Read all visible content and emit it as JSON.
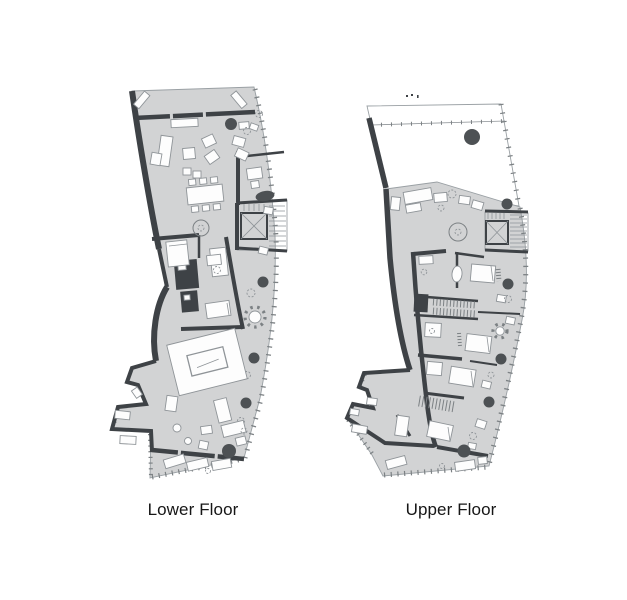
{
  "captions": {
    "note": "floor plan sheet with two stacked apartment levels",
    "lower": "Lower Floor",
    "upper": "Upper Floor"
  },
  "plans": [
    {
      "id": "lower-floor",
      "label": "Lower Floor"
    },
    {
      "id": "upper-floor",
      "label": "Upper Floor"
    }
  ],
  "colors": {
    "background": "#ffffff",
    "floor": "#d2d3d4",
    "wall": "#3e4246",
    "furniture-fill": "#fdfdfd",
    "furniture-outline": "#8f9498",
    "column": "#4d5154",
    "edge": "#9aa0a4",
    "hatch": "#7c8184",
    "text": "#161616"
  }
}
